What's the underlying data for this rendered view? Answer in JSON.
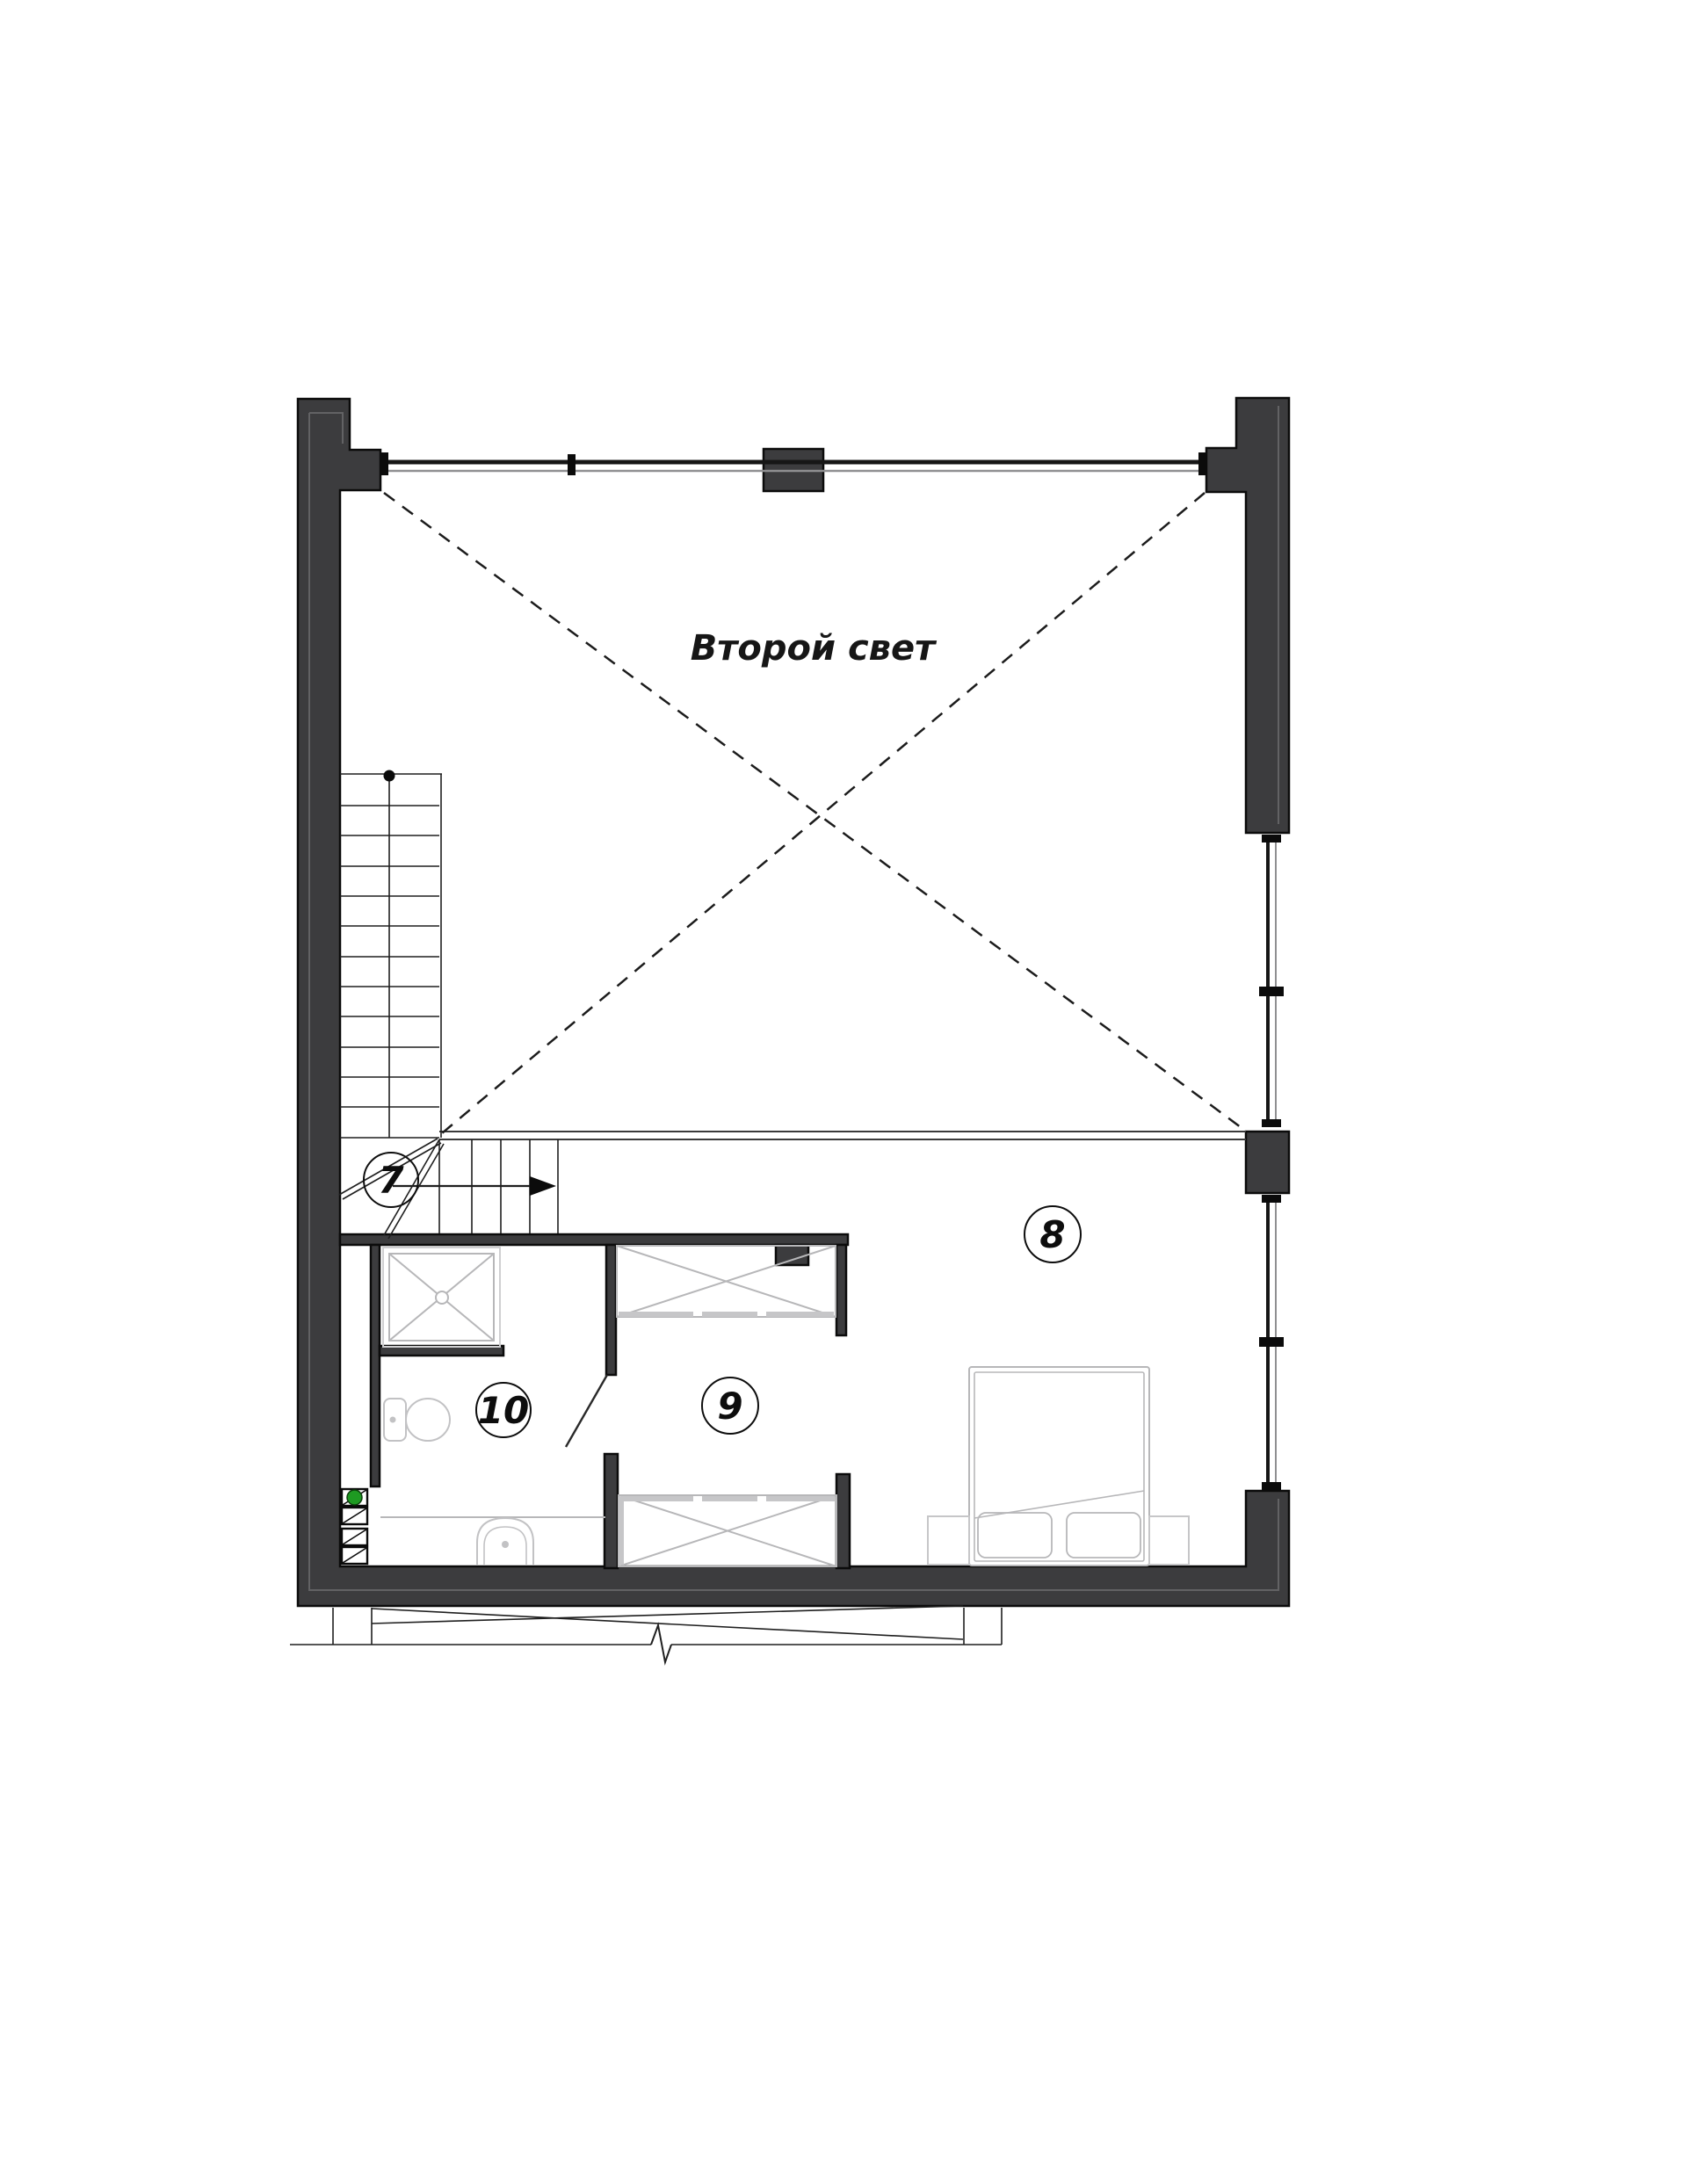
{
  "plan": {
    "title": "Второй свет",
    "rooms": [
      {
        "number": "7"
      },
      {
        "number": "8"
      },
      {
        "number": "9"
      },
      {
        "number": "10"
      }
    ],
    "colors": {
      "wall": "#3c3c3e",
      "outline": "#0b0b0b",
      "glass_dark": "#161616",
      "glass_light": "#8f8f91",
      "furniture": "#b7b7b9",
      "railing": "#3a3a3a",
      "dashed": "#1c1c1c",
      "vent_green": "#1e9a22"
    }
  }
}
